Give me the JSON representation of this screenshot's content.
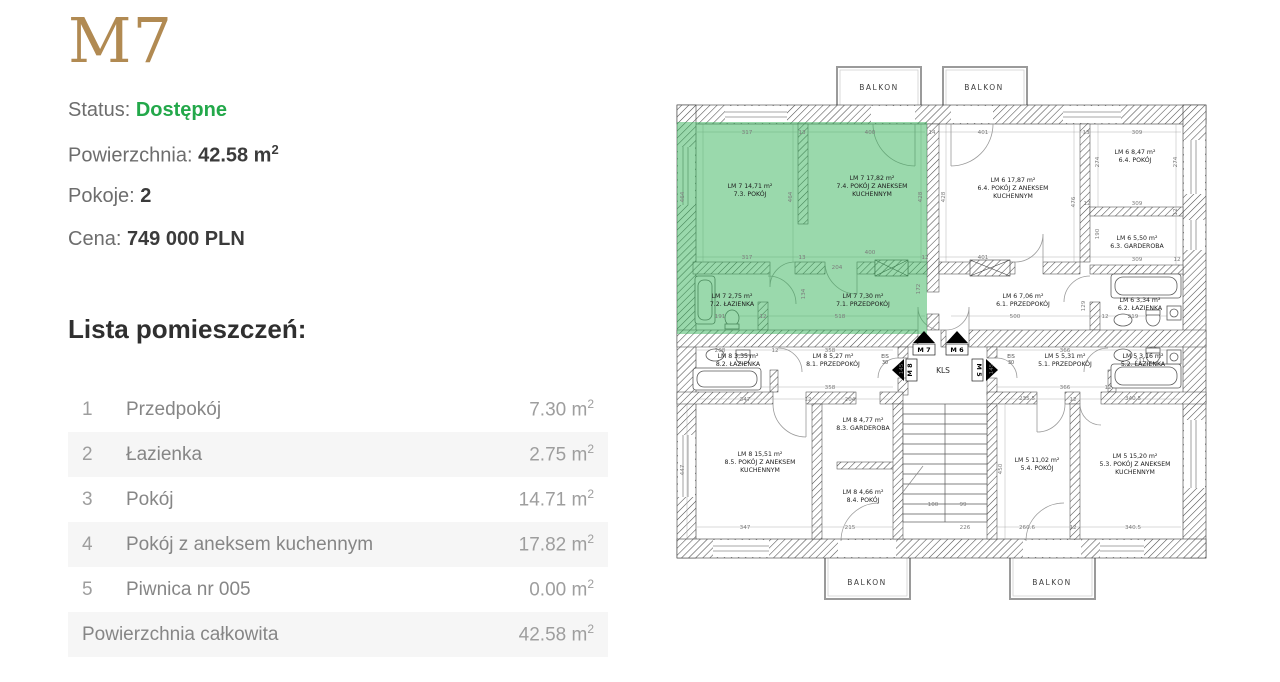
{
  "listing": {
    "title": "M7",
    "status_label": "Status:",
    "status_value": "Dostępne",
    "area_label": "Powierzchnia:",
    "area_value": "42.58 m",
    "area_sup": "2",
    "rooms_label": "Pokoje:",
    "rooms_value": "2",
    "price_label": "Cena:",
    "price_value": "749 000 PLN"
  },
  "room_table": {
    "heading": "Lista pomieszczeń:",
    "unit": " m",
    "sup": "2",
    "rows": [
      {
        "no": "1",
        "name": "Przedpokój",
        "area": "7.30"
      },
      {
        "no": "2",
        "name": "Łazienka",
        "area": "2.75"
      },
      {
        "no": "3",
        "name": "Pokój",
        "area": "14.71"
      },
      {
        "no": "4",
        "name": "Pokój z aneksem kuchennym",
        "area": "17.82"
      },
      {
        "no": "5",
        "name": "Piwnica nr 005",
        "area": "0.00"
      }
    ],
    "total": {
      "name": "Powierzchnia całkowita",
      "area": "42.58"
    }
  },
  "colors": {
    "brand_gold": "#b18a52",
    "status_green": "#23a84a",
    "highlight_green": "#35b459",
    "alt_row_bg": "#f6f6f6"
  },
  "floorplan": {
    "balcony_label": "BALKON",
    "kls": {
      "t": "KLS",
      "x": 268,
      "y": 311
    },
    "eis": {
      "t1": "EIS",
      "t2": "30",
      "pos": [
        [
          210,
          296
        ],
        [
          336,
          296
        ]
      ]
    },
    "balconies": [
      {
        "x": 204,
        "y": 28
      },
      {
        "x": 309,
        "y": 28
      },
      {
        "x": 192,
        "y": 523
      },
      {
        "x": 377,
        "y": 523
      }
    ],
    "markers": [
      {
        "t": "M 7",
        "x": 249,
        "y": 290,
        "r": 0
      },
      {
        "t": "M 6",
        "x": 282,
        "y": 290,
        "r": 0
      },
      {
        "t": "M 8",
        "x": 237,
        "y": 308,
        "r": -90
      },
      {
        "t": "M 5",
        "x": 302,
        "y": 308,
        "r": 90
      }
    ],
    "room_labels": [
      {
        "x": 75,
        "y": 126,
        "lm": "LM 7",
        "area": "14,71 m²",
        "num": "7.3.",
        "name": "POKÓJ"
      },
      {
        "x": 197,
        "y": 118,
        "lm": "LM 7",
        "area": "17,82 m²",
        "num": "7.4.",
        "name": "POKÓJ Z ANEKSEM",
        "name2": "KUCHENNYM"
      },
      {
        "x": 57,
        "y": 236,
        "lm": "LM 7",
        "area": "2,75 m²",
        "num": "7.2.",
        "name": "ŁAZIENKA"
      },
      {
        "x": 188,
        "y": 236,
        "lm": "LM 7",
        "area": "7,30 m²",
        "num": "7.1.",
        "name": "PRZEDPOKÓJ"
      },
      {
        "x": 338,
        "y": 120,
        "lm": "LM 6",
        "area": "17,87 m²",
        "num": "6.4.",
        "name": "POKÓJ Z ANEKSEM",
        "name2": "KUCHENNYM"
      },
      {
        "x": 460,
        "y": 92,
        "lm": "LM 6",
        "area": "8,47 m²",
        "num": "6.4.",
        "name": "POKÓJ"
      },
      {
        "x": 462,
        "y": 178,
        "lm": "LM 6",
        "area": "5,50 m²",
        "num": "6.3.",
        "name": "GARDEROBA"
      },
      {
        "x": 348,
        "y": 236,
        "lm": "LM 6",
        "area": "7,06 m²",
        "num": "6.1.",
        "name": "PRZEDPOKÓJ"
      },
      {
        "x": 465,
        "y": 240,
        "lm": "LM 6",
        "area": "3,34 m²",
        "num": "6.2.",
        "name": "ŁAZIENKA"
      },
      {
        "x": 63,
        "y": 296,
        "lm": "LM 8",
        "area": "3,35 m²",
        "num": "8.2.",
        "name": "ŁAZIENKA"
      },
      {
        "x": 158,
        "y": 296,
        "lm": "LM 8",
        "area": "5,27 m²",
        "num": "8.1.",
        "name": "PRZEDPOKÓJ"
      },
      {
        "x": 188,
        "y": 360,
        "lm": "LM 8",
        "area": "4,77 m²",
        "num": "8.3.",
        "name": "GARDEROBA"
      },
      {
        "x": 85,
        "y": 394,
        "lm": "LM 8",
        "area": "15,51 m²",
        "num": "8.5.",
        "name": "POKÓJ Z ANEKSEM",
        "name2": "KUCHENNYM"
      },
      {
        "x": 188,
        "y": 432,
        "lm": "LM 8",
        "area": "4,66 m²",
        "num": "8.4.",
        "name": "POKÓJ"
      },
      {
        "x": 390,
        "y": 296,
        "lm": "LM 5",
        "area": "5,31 m²",
        "num": "5.1.",
        "name": "PRZEDPOKÓJ"
      },
      {
        "x": 468,
        "y": 296,
        "lm": "LM 5",
        "area": "3,16 m²",
        "num": "5.2.",
        "name": "ŁAZIENKA"
      },
      {
        "x": 362,
        "y": 400,
        "lm": "LM 5",
        "area": "11,02 m²",
        "num": "5.4.",
        "name": "POKÓJ"
      },
      {
        "x": 460,
        "y": 396,
        "lm": "LM 5",
        "area": "15,20 m²",
        "num": "5.3.",
        "name": "POKÓJ Z ANEKSEM",
        "name2": "KUCHENNYM"
      }
    ],
    "dims": [
      [
        72,
        72,
        "317"
      ],
      [
        127,
        72,
        "13"
      ],
      [
        195,
        72,
        "400"
      ],
      [
        257,
        72,
        "14"
      ],
      [
        308,
        72,
        "401"
      ],
      [
        411,
        72,
        "13"
      ],
      [
        462,
        72,
        "309"
      ],
      [
        9,
        135,
        "464",
        "v"
      ],
      [
        117,
        135,
        "464",
        "v"
      ],
      [
        247,
        135,
        "428",
        "v"
      ],
      [
        270,
        135,
        "428",
        "v"
      ],
      [
        400,
        140,
        "476",
        "v"
      ],
      [
        424,
        100,
        "274",
        "v"
      ],
      [
        502,
        100,
        "274",
        "v"
      ],
      [
        424,
        172,
        "190",
        "v"
      ],
      [
        502,
        150,
        "12",
        "v"
      ],
      [
        462,
        143,
        "309"
      ],
      [
        412,
        143,
        "12"
      ],
      [
        462,
        199,
        "309"
      ],
      [
        502,
        199,
        "12"
      ],
      [
        72,
        197,
        "317"
      ],
      [
        127,
        197,
        "13"
      ],
      [
        195,
        192,
        "400"
      ],
      [
        162,
        207,
        "204"
      ],
      [
        250,
        197,
        "12"
      ],
      [
        45,
        256,
        "191"
      ],
      [
        88,
        256,
        "12"
      ],
      [
        165,
        256,
        "518"
      ],
      [
        130,
        232,
        "134",
        "v"
      ],
      [
        245,
        227,
        "172",
        "v"
      ],
      [
        308,
        197,
        "401"
      ],
      [
        340,
        256,
        "500"
      ],
      [
        410,
        244,
        "129",
        "v"
      ],
      [
        430,
        256,
        "12"
      ],
      [
        458,
        256,
        "219"
      ],
      [
        45,
        290,
        "208"
      ],
      [
        100,
        290,
        "12"
      ],
      [
        155,
        290,
        "358"
      ],
      [
        390,
        290,
        "366"
      ],
      [
        155,
        327,
        "358"
      ],
      [
        390,
        327,
        "366"
      ],
      [
        433,
        327,
        "12"
      ],
      [
        465,
        300,
        "211"
      ],
      [
        228,
        307,
        "145",
        "v"
      ],
      [
        318,
        307,
        "145",
        "v"
      ],
      [
        70,
        339,
        "347"
      ],
      [
        133,
        339,
        "12"
      ],
      [
        175,
        339,
        "204"
      ],
      [
        352,
        338,
        "235.5"
      ],
      [
        398,
        339,
        "12"
      ],
      [
        458,
        338,
        "340.5"
      ],
      [
        9,
        408,
        "447",
        "v"
      ],
      [
        327,
        407,
        "450",
        "v"
      ],
      [
        258,
        444,
        "100"
      ],
      [
        288,
        444,
        "99"
      ],
      [
        70,
        467,
        "347"
      ],
      [
        175,
        467,
        "215"
      ],
      [
        290,
        467,
        "226"
      ],
      [
        352,
        467,
        "260.6"
      ],
      [
        398,
        467,
        "12"
      ],
      [
        458,
        467,
        "340.5"
      ]
    ]
  }
}
